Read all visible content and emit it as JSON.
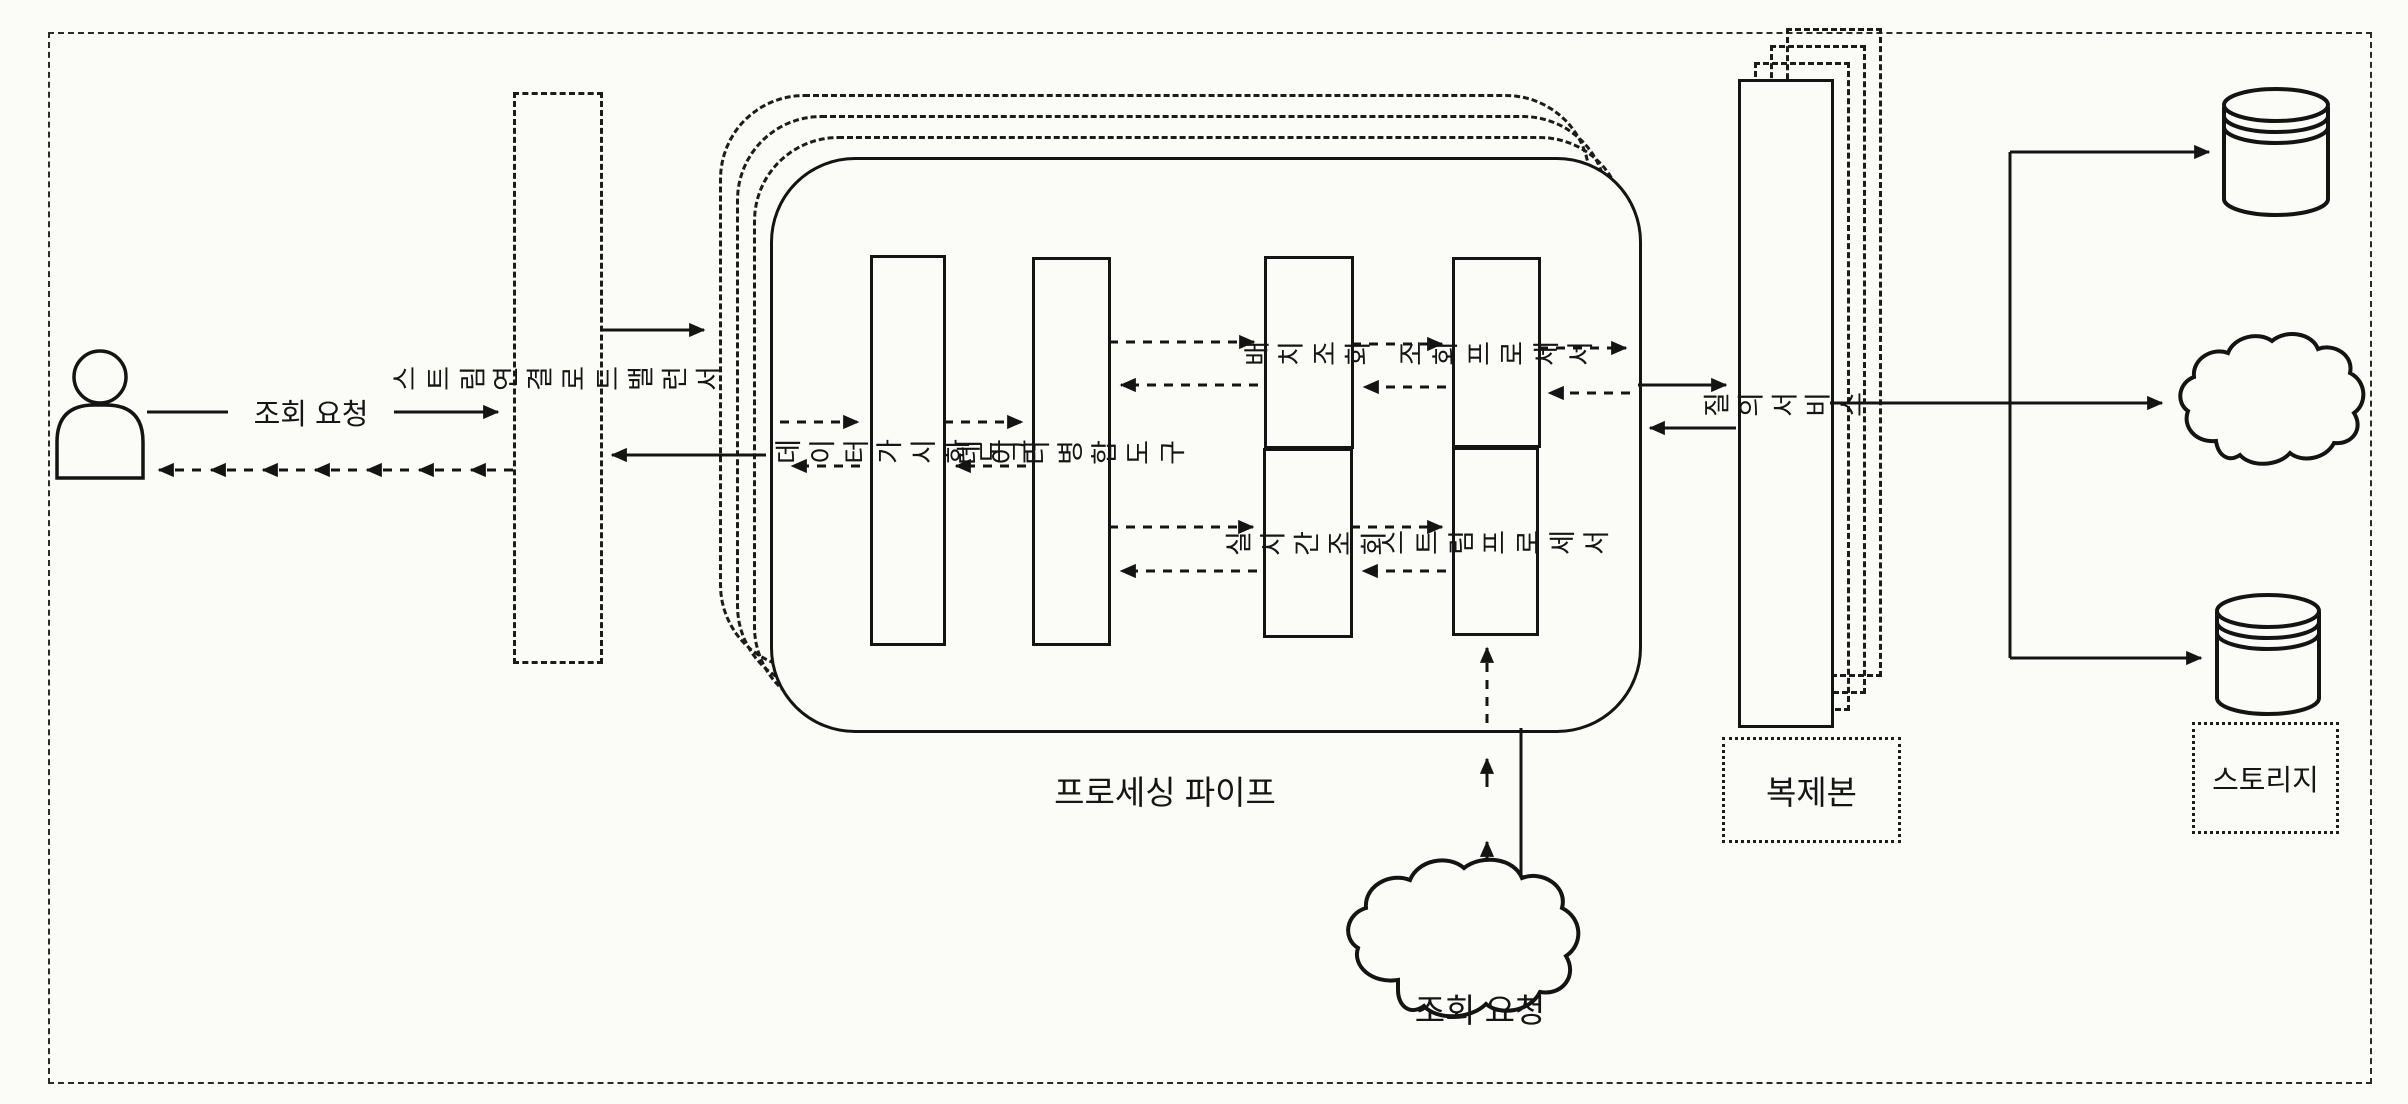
{
  "diagram": {
    "left": {
      "request_label": "조회 요청",
      "load_balancer_label": "스트림 연결 로드 밸런서"
    },
    "pipe": {
      "caption": "프로세싱 파이프",
      "boxes": {
        "visualization_tool": "데이터 가시화 도구",
        "merge_tool": "데이터 병합 도구",
        "batch_query": "배치 조회",
        "realtime_query": "실시간 조회",
        "query_processor": "조회\n프로세서",
        "stream_processor": "스트림\n프로세서"
      }
    },
    "right": {
      "query_service_label": "질의 서비스",
      "replica_tag": "복제본",
      "storage_tag": "스토리지"
    },
    "bottom": {
      "cloud_label": "조회 요청"
    },
    "colors": {
      "ink": "#1a1a1a",
      "paper": "#fbfbf8"
    }
  }
}
